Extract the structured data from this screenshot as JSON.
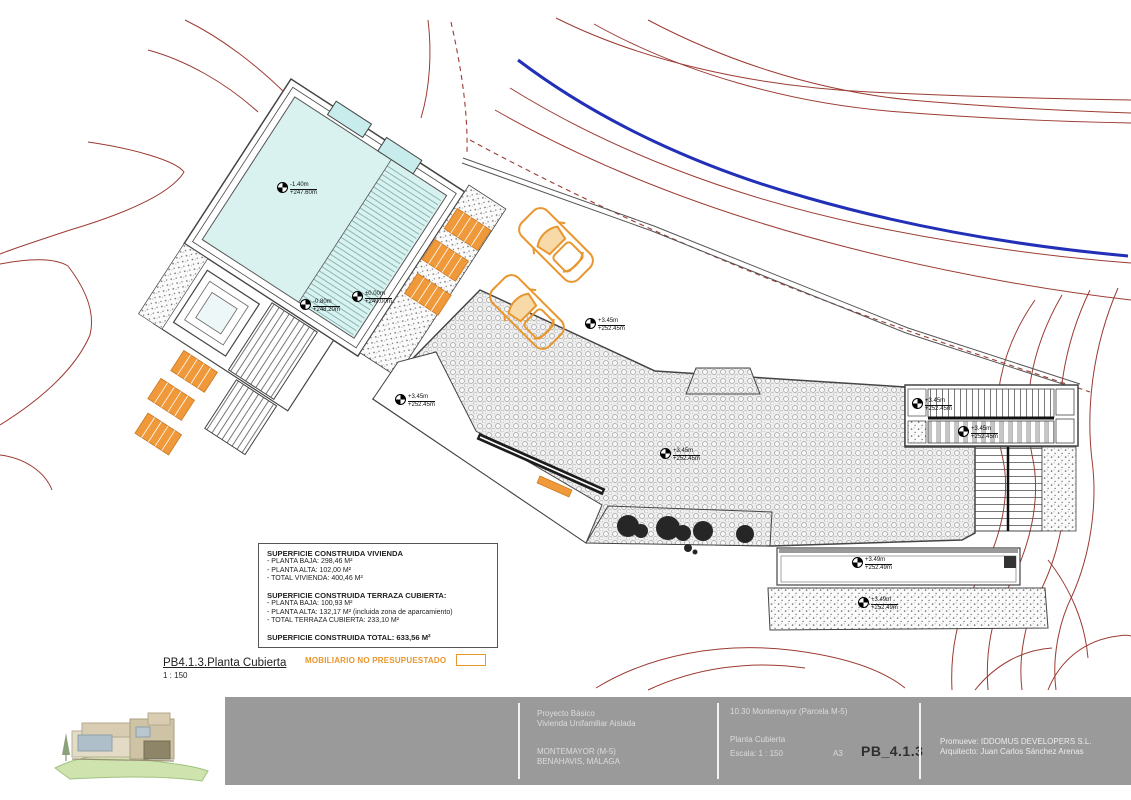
{
  "plan": {
    "label_title": "PB4.1.3.Planta Cubierta",
    "label_scale": "1 : 150",
    "furniture_note": "MOBILIARIO NO PRESUPUESTADO"
  },
  "areas_box": {
    "section1_title": "SUPERFICIE CONSTRUIDA VIVIENDA",
    "section1_lines": [
      "- PLANTA BAJA: 298,46 M²",
      "- PLANTA ALTA: 102,00 M²",
      "- TOTAL VIVIENDA: 400,46 M²"
    ],
    "section2_title": "SUPERFICIE CONSTRUIDA TERRAZA CUBIERTA:",
    "section2_lines": [
      "- PLANTA BAJA: 100,93 M²",
      "- PLANTA ALTA: 132,17 M² (incluida zona de aparcamiento)",
      "- TOTAL TERRAZA CUBIERTA: 233,10 M²"
    ],
    "total_line": "SUPERFICIE CONSTRUIDA TOTAL: 633,56 M²"
  },
  "markers": [
    {
      "rel": "-1.40m",
      "abs": "+247.60m"
    },
    {
      "rel": "-0.80m",
      "abs": "+248.20m"
    },
    {
      "rel": "±0.00m",
      "abs": "+249.00m"
    },
    {
      "rel": "+3.45m",
      "abs": "+252.45m"
    },
    {
      "rel": "+3.45m",
      "abs": "+252.45m"
    },
    {
      "rel": "+3.45m",
      "abs": "+252.45m"
    },
    {
      "rel": "+3.45m",
      "abs": "+252.45m"
    },
    {
      "rel": "+3.45m",
      "abs": "+252.45m"
    },
    {
      "rel": "+3.49m",
      "abs": "+252.49m"
    },
    {
      "rel": "+3.49m",
      "abs": "+252.49m"
    }
  ],
  "titleblock": {
    "project_line1": "Proyecto Básico",
    "project_line2": "Vivienda Unifamiliar Aislada",
    "location_line1": "MONTEMAYOR (M-5)",
    "location_line2": "BENAHAVIS, MÁLAGA",
    "reference": "10.30 Montemayor (Parcela M-5)",
    "plan_name": "Planta Cubierta",
    "scale_label": "Escala: 1 : 150",
    "paper_size": "A3",
    "sheet_code": "PB_4.1.3",
    "promoter": "Promueve: IDDOMUS DEVELOPERS S.L.",
    "architect": "Arquitecto: Juan Carlos Sánchez Arenas"
  },
  "colors": {
    "contour_red": "#9c3b33",
    "boundary_blue": "#2230b8",
    "pool_water": "#d9f2f0",
    "furniture_orange": "#e8962e",
    "titleblock_bg": "#9a9a9a"
  }
}
